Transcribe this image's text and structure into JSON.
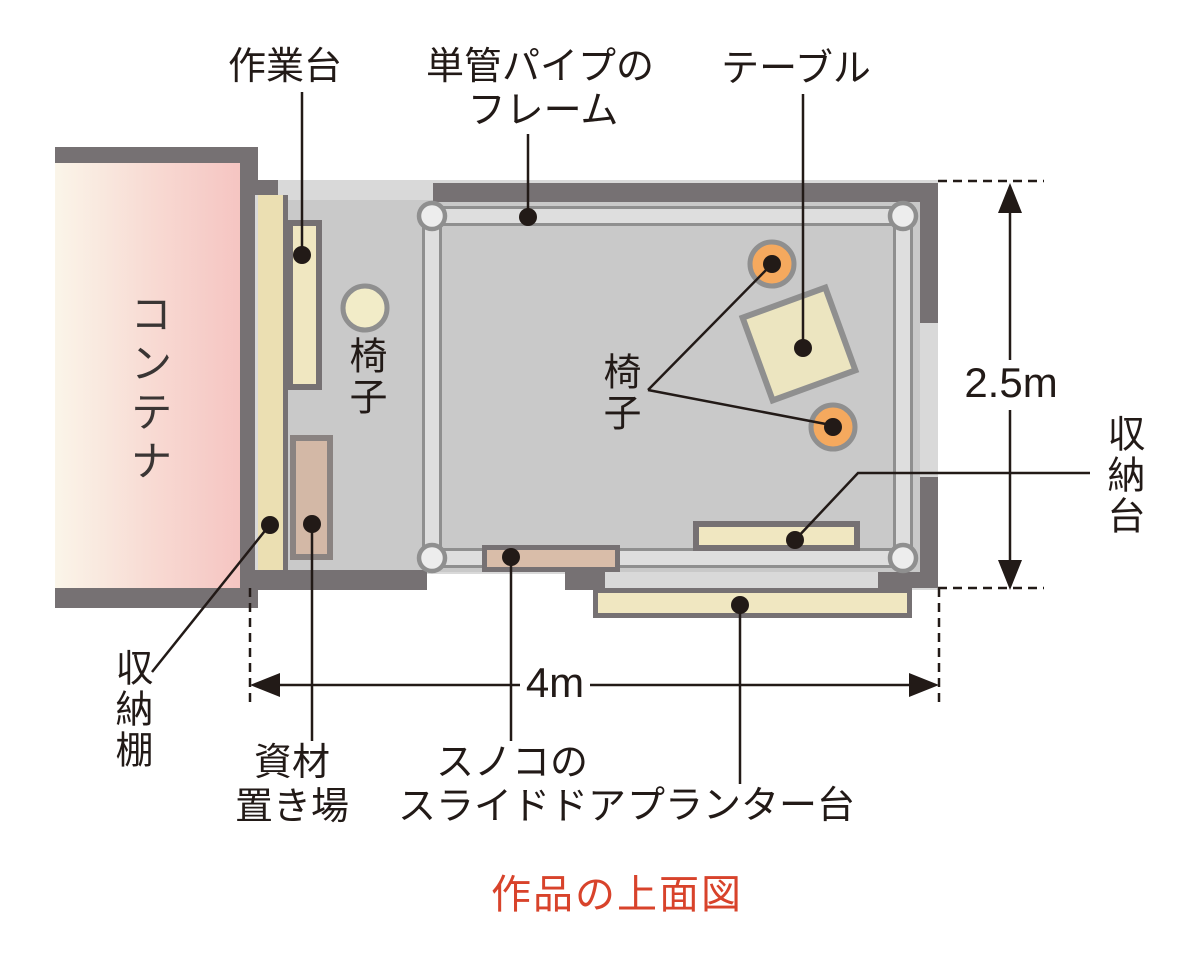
{
  "figure": {
    "title": "作品の上面図",
    "title_color": "#d8432b"
  },
  "dimensions": {
    "width": "4m",
    "height": "2.5m"
  },
  "labels": {
    "container": "コンテナ",
    "workbench": "作業台",
    "pipe_frame": [
      "単管パイプの",
      "フレーム"
    ],
    "table": "テーブル",
    "chair_single": "椅子",
    "chairs_pair": "椅子",
    "storage_shelf": "収納棚",
    "material_area": [
      "資材",
      "置き場"
    ],
    "sliding_door": [
      "スノコの",
      "スライドドア"
    ],
    "planter_stand": "プランター台",
    "storage_stand": "収納台"
  },
  "colors": {
    "wall": "#767173",
    "floor": "#c9c9c9",
    "roof_band": "#d9d9d9",
    "container_pink": "#f6c7c4",
    "container_cream": "#faf5e9",
    "furniture_cream": "#f0e7c1",
    "shelf_tan": "#ebdfb2",
    "material_brown": "#d3b8a6",
    "door_brown": "#d9bda9",
    "chair_orange": "#f5a95e",
    "pipe_fill": "#dedede",
    "pipe_edge": "#8f8f8f",
    "annotation": "#221a17"
  }
}
